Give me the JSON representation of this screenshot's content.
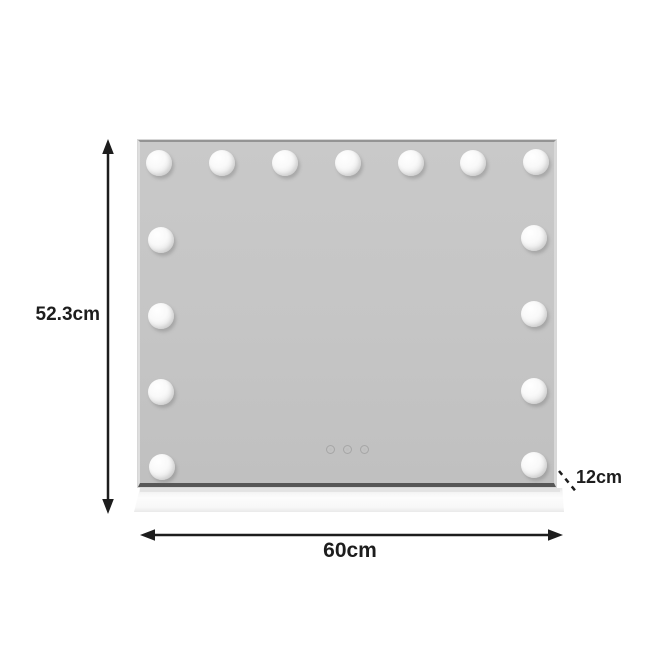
{
  "dimension_labels": {
    "height": "52.3cm",
    "width": "60cm",
    "depth": "12cm"
  },
  "mirror": {
    "bulb_count": 15,
    "bulbs_top_row": 7,
    "bulbs_left_column": 4,
    "bulbs_right_column": 4,
    "touch_button_count": 3,
    "touch_icons": [
      "touch-sensor-icon",
      "touch-sensor-icon",
      "touch-sensor-icon"
    ]
  },
  "colors": {
    "background": "#ffffff",
    "mirror_fill": "#c5c5c5",
    "mirror_bottom_edge": "#565656",
    "bulb_fill": "#ffffff",
    "base_fill": "#f9f9f9",
    "dimension_line": "#1d1d1d",
    "label_text": "#1d1d1d"
  }
}
